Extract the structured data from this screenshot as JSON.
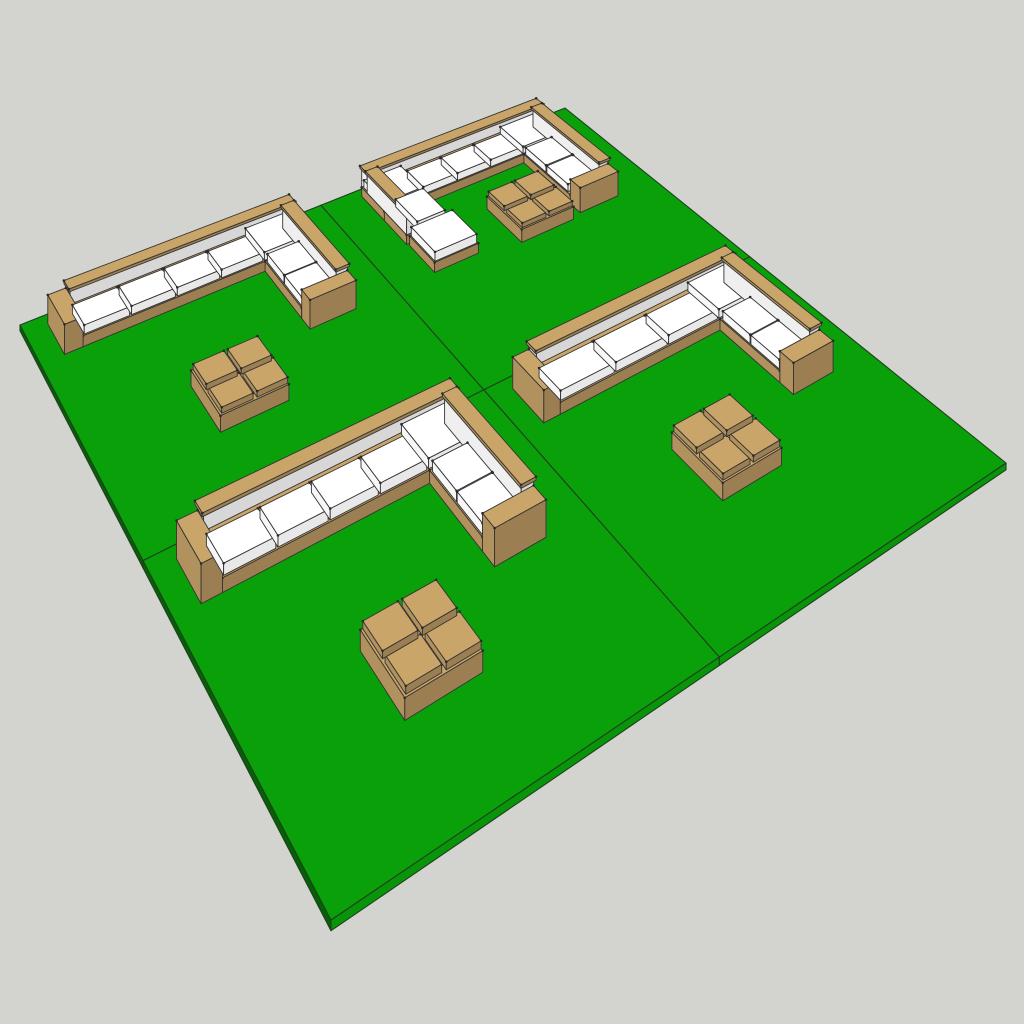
{
  "canvas": {
    "width": 1024,
    "height": 1024,
    "background": "#d3d3d0"
  },
  "view": {
    "ground_corners_px": [
      [
        331,
        920
      ],
      [
        1006,
        463
      ],
      [
        565,
        108
      ],
      [
        20,
        325
      ]
    ],
    "world_size": 20,
    "height_scale_px": 44,
    "ref_point": [
      5,
      5
    ]
  },
  "materials": {
    "green": {
      "base": "#0aa00a",
      "f": [
        1,
        0.6,
        0.93,
        0.75,
        0.85
      ]
    },
    "tan": {
      "base": "#c9a56a",
      "f": [
        1,
        0.88,
        0.77,
        0.7,
        0.88
      ]
    },
    "white": {
      "base": "#ffffff",
      "f": [
        1,
        0.97,
        0.91,
        0.87,
        0.97
      ]
    },
    "whiteback": {
      "base": "#f4f4f4",
      "f": [
        1,
        0.98,
        0.88,
        0.86,
        0.98
      ]
    }
  },
  "strokes": {
    "furniture": {
      "color": "#343434",
      "width": 0.9
    },
    "mat": {
      "color": "#1d401d",
      "width": 1.1
    },
    "dot": {
      "color": "#2a2a2a",
      "radius": 1.3
    }
  },
  "mat": {
    "size": 10,
    "thickness": 0.18
  },
  "mats": [
    {
      "name": "mat-far",
      "offset": [
        10,
        10
      ],
      "set": "u_shape"
    },
    {
      "name": "mat-left",
      "offset": [
        0,
        10
      ],
      "set": "l_shape_4seat"
    },
    {
      "name": "mat-right",
      "offset": [
        10,
        0
      ],
      "set": "l_shape_3seat"
    },
    {
      "name": "mat-near",
      "offset": [
        0,
        0
      ],
      "set": "l_shape_4seat"
    }
  ],
  "sets": {
    "l_shape_4seat": [
      {
        "n": "backrest-long",
        "m": "whiteback",
        "b": [
          1.25,
          9.2,
          7.35,
          0.38,
          0.34,
          1.06
        ]
      },
      {
        "n": "backrest-cap-long",
        "m": "tan",
        "b": [
          1.2,
          9.16,
          7.45,
          0.46,
          1.06,
          1.15
        ]
      },
      {
        "n": "sofa-base-long",
        "m": "tan",
        "b": [
          1.25,
          8.05,
          7.35,
          1.53,
          0,
          0.34
        ]
      },
      {
        "n": "arm-left",
        "m": "tan",
        "b": [
          0.7,
          8.05,
          0.55,
          1.53,
          0,
          0.92
        ]
      },
      {
        "n": "seat-cushion-1",
        "m": "white",
        "b": [
          1.3,
          8.1,
          1.38,
          1.04,
          0.34,
          0.62
        ]
      },
      {
        "n": "seat-cushion-2",
        "m": "white",
        "b": [
          2.74,
          8.1,
          1.38,
          1.04,
          0.34,
          0.62
        ]
      },
      {
        "n": "seat-cushion-3",
        "m": "white",
        "b": [
          4.18,
          8.1,
          1.38,
          1.04,
          0.34,
          0.62
        ]
      },
      {
        "n": "seat-cushion-4",
        "m": "white",
        "b": [
          5.62,
          8.1,
          1.38,
          1.04,
          0.34,
          0.62
        ]
      },
      {
        "n": "corner-seat",
        "m": "white",
        "b": [
          7.06,
          8.1,
          1.48,
          1.42,
          0.34,
          0.62
        ]
      },
      {
        "n": "sofa-base-return",
        "m": "tan",
        "b": [
          7.06,
          5.5,
          1.54,
          2.55,
          0,
          0.34
        ]
      },
      {
        "n": "backrest-return",
        "m": "whiteback",
        "b": [
          8.22,
          5.5,
          0.38,
          3.7,
          0.34,
          1.06
        ]
      },
      {
        "n": "backrest-cap-return",
        "m": "tan",
        "b": [
          8.18,
          5.45,
          0.46,
          3.8,
          1.06,
          1.15
        ]
      },
      {
        "n": "seat-cushion-5",
        "m": "white",
        "b": [
          7.1,
          6.78,
          1.08,
          1.19,
          0.34,
          0.62
        ]
      },
      {
        "n": "seat-cushion-6",
        "m": "white",
        "b": [
          7.1,
          5.56,
          1.08,
          1.19,
          0.34,
          0.62
        ]
      },
      {
        "n": "arm-front",
        "m": "tan",
        "b": [
          7.06,
          4.95,
          1.54,
          0.55,
          0,
          0.92
        ]
      },
      {
        "n": "coffee-table-base",
        "m": "tan",
        "b": [
          3.25,
          2.75,
          2.05,
          2.05,
          0,
          0.46
        ]
      },
      {
        "n": "table-pad-1",
        "m": "tan",
        "b": [
          3.31,
          2.81,
          0.93,
          0.93,
          0.46,
          0.63
        ]
      },
      {
        "n": "table-pad-2",
        "m": "tan",
        "b": [
          4.36,
          2.81,
          0.93,
          0.93,
          0.46,
          0.63
        ]
      },
      {
        "n": "table-pad-3",
        "m": "tan",
        "b": [
          3.31,
          3.86,
          0.93,
          0.93,
          0.46,
          0.63
        ]
      },
      {
        "n": "table-pad-4",
        "m": "tan",
        "b": [
          4.36,
          3.86,
          0.93,
          0.93,
          0.46,
          0.63
        ]
      }
    ],
    "l_shape_3seat": [
      {
        "n": "backrest-long",
        "m": "whiteback",
        "b": [
          1.25,
          9.2,
          7.35,
          0.38,
          0.34,
          1.06
        ]
      },
      {
        "n": "backrest-cap-long",
        "m": "tan",
        "b": [
          1.2,
          9.16,
          7.45,
          0.46,
          1.06,
          1.15
        ]
      },
      {
        "n": "sofa-base-long",
        "m": "tan",
        "b": [
          1.25,
          8.05,
          7.35,
          1.53,
          0,
          0.34
        ]
      },
      {
        "n": "arm-left",
        "m": "tan",
        "b": [
          0.7,
          8.05,
          0.55,
          1.53,
          0,
          0.92
        ]
      },
      {
        "n": "seat-cushion-1",
        "m": "white",
        "b": [
          1.3,
          8.1,
          1.86,
          1.04,
          0.34,
          0.62
        ]
      },
      {
        "n": "seat-cushion-2",
        "m": "white",
        "b": [
          3.22,
          8.1,
          1.86,
          1.04,
          0.34,
          0.62
        ]
      },
      {
        "n": "seat-cushion-3",
        "m": "white",
        "b": [
          5.14,
          8.1,
          1.86,
          1.04,
          0.34,
          0.62
        ]
      },
      {
        "n": "corner-seat",
        "m": "white",
        "b": [
          7.06,
          8.1,
          1.48,
          1.42,
          0.34,
          0.62
        ]
      },
      {
        "n": "sofa-base-return",
        "m": "tan",
        "b": [
          7.06,
          5.5,
          1.54,
          2.55,
          0,
          0.34
        ]
      },
      {
        "n": "backrest-return",
        "m": "whiteback",
        "b": [
          8.22,
          5.5,
          0.38,
          3.7,
          0.34,
          1.06
        ]
      },
      {
        "n": "backrest-cap-return",
        "m": "tan",
        "b": [
          8.18,
          5.45,
          0.46,
          3.8,
          1.06,
          1.15
        ]
      },
      {
        "n": "seat-cushion-4",
        "m": "white",
        "b": [
          7.1,
          6.78,
          1.08,
          1.19,
          0.34,
          0.62
        ]
      },
      {
        "n": "seat-cushion-5",
        "m": "white",
        "b": [
          7.1,
          5.56,
          1.08,
          1.19,
          0.34,
          0.62
        ]
      },
      {
        "n": "arm-front",
        "m": "tan",
        "b": [
          7.06,
          4.95,
          1.54,
          0.55,
          0,
          0.92
        ]
      },
      {
        "n": "coffee-table-base",
        "m": "tan",
        "b": [
          3.0,
          3.3,
          2.05,
          2.05,
          0,
          0.46
        ]
      },
      {
        "n": "table-pad-1",
        "m": "tan",
        "b": [
          3.06,
          3.36,
          0.93,
          0.93,
          0.46,
          0.63
        ]
      },
      {
        "n": "table-pad-2",
        "m": "tan",
        "b": [
          4.11,
          3.36,
          0.93,
          0.93,
          0.46,
          0.63
        ]
      },
      {
        "n": "table-pad-3",
        "m": "tan",
        "b": [
          3.06,
          4.41,
          0.93,
          0.93,
          0.46,
          0.63
        ]
      },
      {
        "n": "table-pad-4",
        "m": "tan",
        "b": [
          4.11,
          4.41,
          0.93,
          0.93,
          0.46,
          0.63
        ]
      }
    ],
    "u_shape": [
      {
        "n": "backrest-back",
        "m": "whiteback",
        "b": [
          1.35,
          9.27,
          7.1,
          0.38,
          0.34,
          1.06
        ]
      },
      {
        "n": "backrest-cap-back",
        "m": "tan",
        "b": [
          1.3,
          9.23,
          7.2,
          0.46,
          1.06,
          1.15
        ]
      },
      {
        "n": "sofa-base-back",
        "m": "tan",
        "b": [
          1.35,
          8.1,
          7.1,
          1.55,
          0,
          0.34
        ]
      },
      {
        "n": "corner-seat-left",
        "m": "white",
        "b": [
          1.4,
          8.15,
          1.42,
          1.44,
          0.34,
          0.62
        ]
      },
      {
        "n": "seat-cushion-1",
        "m": "white",
        "b": [
          2.86,
          8.15,
          1.3,
          1.06,
          0.34,
          0.62
        ]
      },
      {
        "n": "seat-cushion-2",
        "m": "white",
        "b": [
          4.2,
          8.15,
          1.3,
          1.06,
          0.34,
          0.62
        ]
      },
      {
        "n": "seat-cushion-3",
        "m": "white",
        "b": [
          5.54,
          8.15,
          1.3,
          1.06,
          0.34,
          0.62
        ]
      },
      {
        "n": "corner-seat-right",
        "m": "white",
        "b": [
          6.88,
          8.15,
          1.5,
          1.44,
          0.34,
          0.62
        ]
      },
      {
        "n": "sofa-base-left",
        "m": "tan",
        "b": [
          1.35,
          6.65,
          1.5,
          1.45,
          0,
          0.34
        ]
      },
      {
        "n": "backrest-left",
        "m": "whiteback",
        "b": [
          1.35,
          6.65,
          0.38,
          2.62,
          0.34,
          1.06
        ]
      },
      {
        "n": "backrest-cap-left",
        "m": "tan",
        "b": [
          1.31,
          6.6,
          0.46,
          2.72,
          1.06,
          1.15
        ]
      },
      {
        "n": "seat-cushion-left",
        "m": "white",
        "b": [
          1.77,
          6.69,
          1.04,
          1.4,
          0.34,
          0.62
        ]
      },
      {
        "n": "sofa-base-right",
        "m": "tan",
        "b": [
          6.88,
          5.35,
          1.57,
          2.75,
          0,
          0.34
        ]
      },
      {
        "n": "backrest-right",
        "m": "whiteback",
        "b": [
          8.07,
          5.35,
          0.38,
          3.92,
          0.34,
          1.06
        ]
      },
      {
        "n": "backrest-cap-right",
        "m": "tan",
        "b": [
          8.03,
          5.3,
          0.46,
          4.02,
          1.06,
          1.15
        ]
      },
      {
        "n": "seat-cushion-r1",
        "m": "white",
        "b": [
          6.92,
          6.82,
          1.1,
          1.23,
          0.34,
          0.62
        ]
      },
      {
        "n": "seat-cushion-r2",
        "m": "white",
        "b": [
          6.92,
          5.54,
          1.1,
          1.23,
          0.34,
          0.62
        ]
      },
      {
        "n": "arm-front",
        "m": "tan",
        "b": [
          6.88,
          4.8,
          1.57,
          0.55,
          0,
          0.92
        ]
      },
      {
        "n": "daybed-base",
        "m": "tan",
        "b": [
          1.4,
          5.0,
          1.62,
          1.55,
          0,
          0.34
        ]
      },
      {
        "n": "daybed-cushion",
        "m": "white",
        "b": [
          1.44,
          5.04,
          1.54,
          1.47,
          0.34,
          0.66
        ]
      },
      {
        "n": "coffee-table-base",
        "m": "tan",
        "b": [
          4.45,
          4.65,
          2.05,
          2.05,
          0,
          0.46
        ]
      },
      {
        "n": "table-pad-1",
        "m": "tan",
        "b": [
          4.51,
          4.71,
          0.93,
          0.93,
          0.46,
          0.63
        ]
      },
      {
        "n": "table-pad-2",
        "m": "tan",
        "b": [
          5.56,
          4.71,
          0.93,
          0.93,
          0.46,
          0.63
        ]
      },
      {
        "n": "table-pad-3",
        "m": "tan",
        "b": [
          4.51,
          5.76,
          0.93,
          0.93,
          0.46,
          0.63
        ]
      },
      {
        "n": "table-pad-4",
        "m": "tan",
        "b": [
          5.56,
          5.76,
          0.93,
          0.93,
          0.46,
          0.63
        ]
      }
    ]
  }
}
